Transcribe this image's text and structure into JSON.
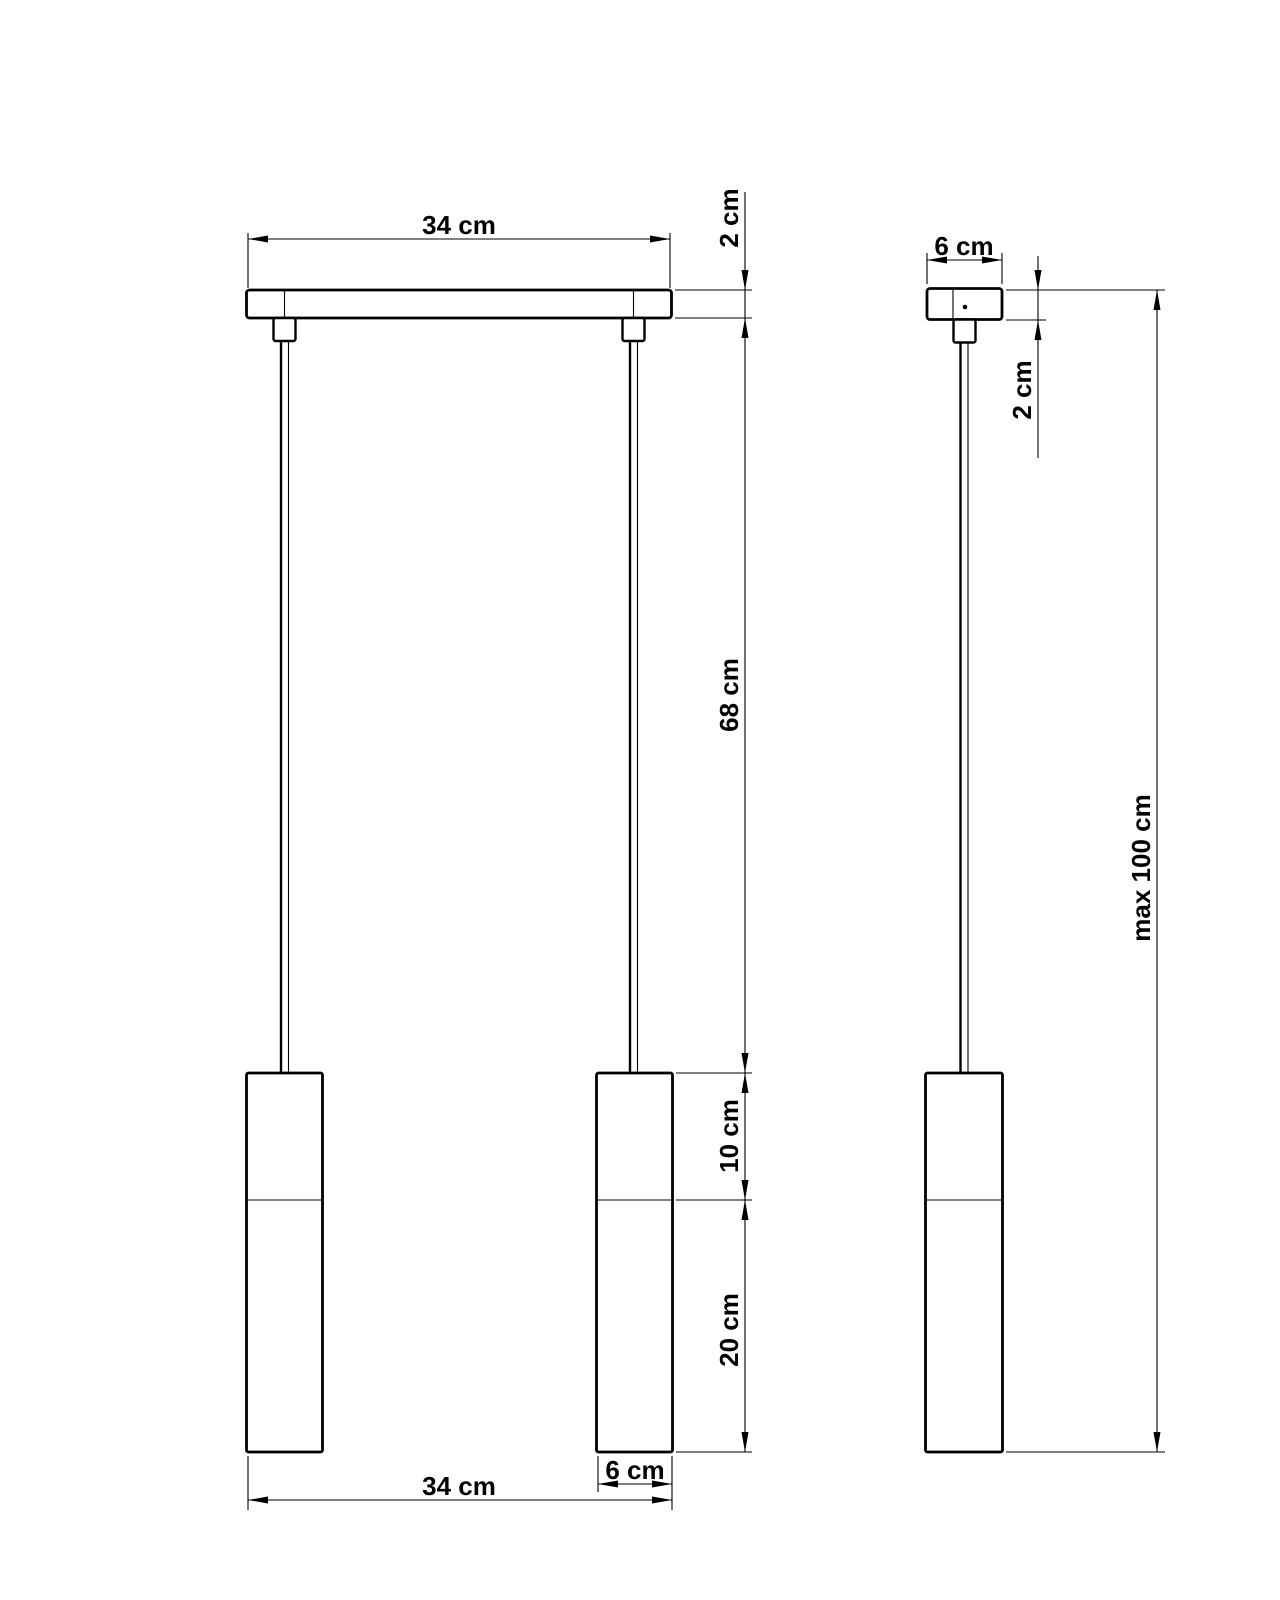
{
  "colors": {
    "line": "#000000",
    "background": "#ffffff"
  },
  "front_view": {
    "top_width_label": "34 cm",
    "canopy_thickness_label": "2 cm",
    "cable_length_label": "68 cm",
    "shade_upper_section_label": "10 cm",
    "shade_lower_section_label": "20 cm",
    "shade_diameter_label": "6 cm",
    "bottom_width_label": "34 cm"
  },
  "side_view": {
    "canopy_width_label": "6 cm",
    "canopy_thickness_label": "2 cm",
    "max_drop_label": "max 100 cm"
  }
}
